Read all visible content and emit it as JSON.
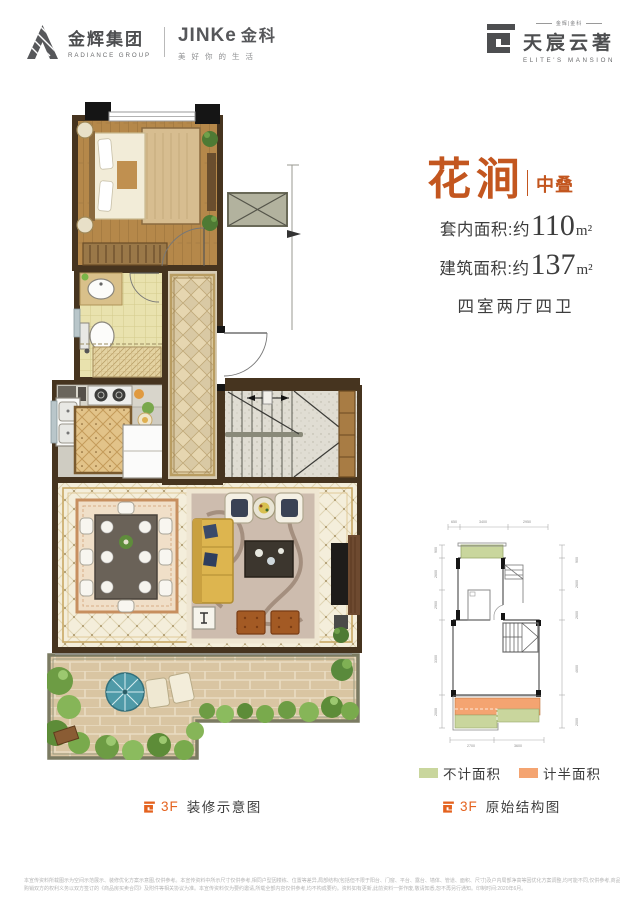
{
  "header": {
    "group_cn": "金辉集团",
    "group_en": "RADIANCE GROUP",
    "jinke_latin": "JINKe",
    "jinke_cn": "金科",
    "jinke_tagline": "美好你的生活",
    "mansion_small": "金辉|金科",
    "mansion_cn": "天宸云著",
    "mansion_en": "ELITE'S MANSION"
  },
  "unit": {
    "name": "花涧",
    "badge": "中叠",
    "inner_area_label": "套内面积:约",
    "inner_area_value": "110",
    "inner_area_unit": "m²",
    "build_area_label": "建筑面积:约",
    "build_area_value": "137",
    "build_area_unit": "m²",
    "layout_text": "四室两厅四卫"
  },
  "captions": {
    "left_floor": "3F",
    "left_text": "装修示意图",
    "right_floor": "3F",
    "right_text": "原始结构图"
  },
  "legend": {
    "items": [
      {
        "label": "不计面积",
        "color": "#c9d69d"
      },
      {
        "label": "计半面积",
        "color": "#f4a471"
      }
    ]
  },
  "dims": {
    "top": [
      "650",
      "3400",
      "2950"
    ],
    "left": [
      "900",
      "2600",
      "2900",
      "3300",
      "2000"
    ],
    "right": [
      "900",
      "2600",
      "2600",
      "4600",
      "2000"
    ],
    "bottom": [
      "2700",
      "3600"
    ]
  },
  "disclaimer": {
    "line1": "本宣传资料所载图示为空间示范展示、装修优化方案示意图,仅供参考。本宣传资料中所示尺寸仅供参考,相同户型因楼栋、位置等差异,局部结构(包括但不限于阳台、门窗、平台、露台、墙体、管道、面积、尺寸)及户内局部净高等因优化方案调整,均可能不同,仅供参考,商品房实际交付之时,",
    "line2": "购销双方的权利义务以双方签订的《商品房买卖合同》及附件等相关协议为准。本宣传资料仅为要约邀请,所载全部内容仅供参考,均不构成要约。资料如有更新,此前资料一併作废,敬请知悉,恕不再另行通知。印制时间:2020年6月。"
  },
  "colors": {
    "accent_orange": "#e4621e",
    "title_orange": "#c3561f",
    "text_dark": "#3d3d3d",
    "logo_gray": "#4d4e50",
    "not_counted_green": "#c9d69d",
    "half_counted_orange": "#f4a471",
    "wall_brown": "#46341f",
    "wood_floor": "#b5884a",
    "terrace_paver": "#d9c5a2",
    "umbrella_teal": "#4f9aa8"
  }
}
